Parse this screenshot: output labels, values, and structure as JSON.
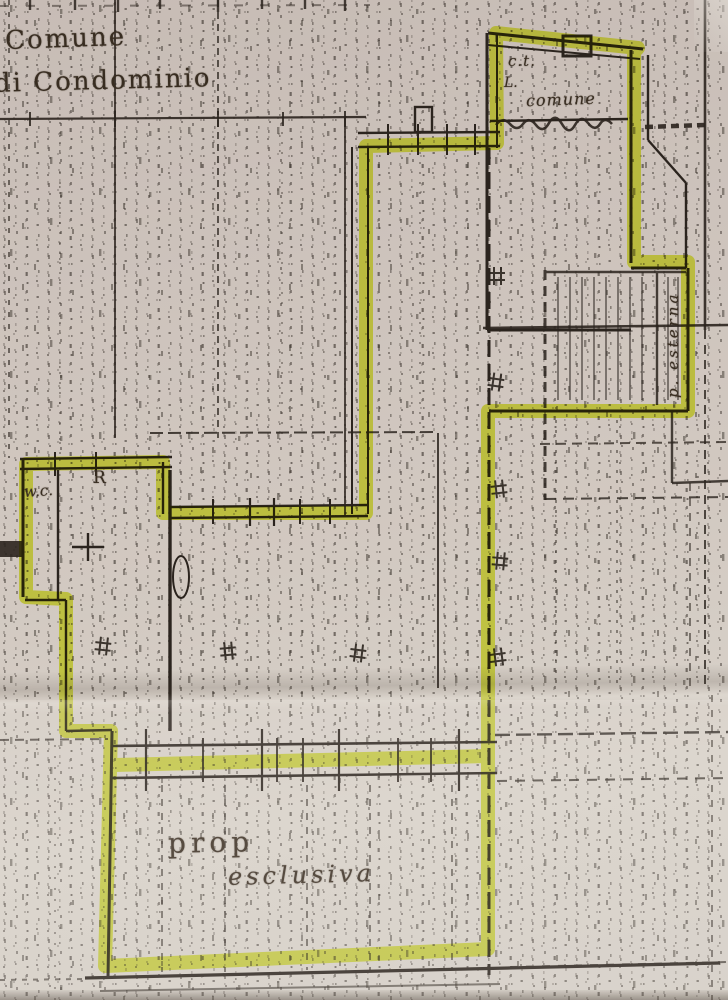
{
  "labels": {
    "region_line1": "Comune",
    "region_line2": "di Condominio",
    "boiler_abbr": "c.t.",
    "boiler_sub": "L.",
    "boiler_name": "comune",
    "external_area": "p. esterna",
    "wc": "w.c.",
    "room_r": "R",
    "exclusive_line1": "prop",
    "exclusive_line2": "esclusiva"
  },
  "colors": {
    "highlighter": "#e2f136",
    "ink": "#2b241e",
    "paper_top": "#c7bcb5",
    "paper_bottom": "#d8d2ca"
  }
}
